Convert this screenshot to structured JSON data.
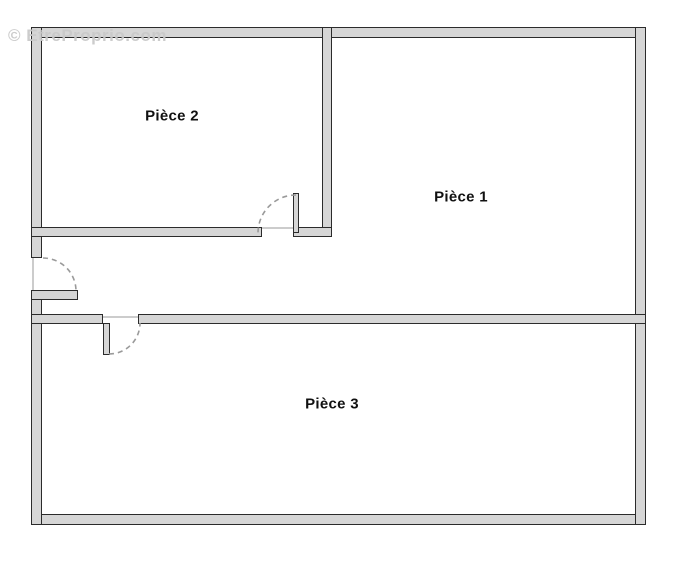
{
  "watermark": {
    "text": "© EtreProprio.com",
    "color": "#c9c9c9"
  },
  "rooms": [
    {
      "label": "Pièce 2"
    },
    {
      "label": "Pièce 1"
    },
    {
      "label": "Pièce 3"
    }
  ],
  "doors": [
    {
      "name": "entrance-door-swing"
    },
    {
      "name": "piece-2-door-swing"
    },
    {
      "name": "piece-3-door-swing"
    }
  ],
  "colors": {
    "background": "#ffffff",
    "wall_fill": "#d6d6d6",
    "wall_outline": "#2b2b2b",
    "door_arc": "#9a9a9a",
    "threshold": "#cccccc",
    "label_text": "#111111",
    "watermark_text": "#c9c9c9"
  }
}
